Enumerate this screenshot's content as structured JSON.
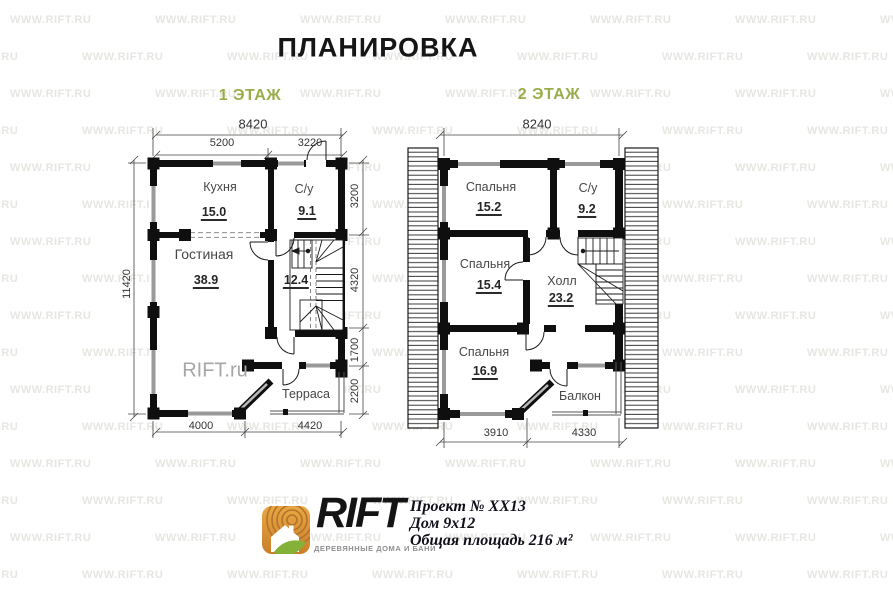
{
  "title": "ПЛАНИРОВКА",
  "watermark": {
    "text": "WWW.RIFT.RU"
  },
  "floor1": {
    "label": "1 ЭТАЖ",
    "plan_watermark": "RIFT.ru",
    "dims": {
      "top_total": "8420",
      "top_left": "5200",
      "top_right": "3220",
      "left_total": "11420",
      "right": [
        "3200",
        "4320",
        "1700",
        "2200"
      ],
      "bottom": [
        "4000",
        "4420"
      ]
    },
    "rooms": {
      "kitchen": {
        "name": "Кухня",
        "area": "15.0"
      },
      "wc": {
        "name": "С/у",
        "area": "9.1"
      },
      "living": {
        "name": "Гостиная",
        "area": "38.9"
      },
      "hall": {
        "area": "12.4"
      },
      "terrace": {
        "name": "Терраса"
      }
    }
  },
  "floor2": {
    "label": "2 ЭТАЖ",
    "dims": {
      "top_total": "8240",
      "bottom": [
        "3910",
        "4330"
      ]
    },
    "rooms": {
      "bedroom1": {
        "name": "Спальня",
        "area": "15.2"
      },
      "wc": {
        "name": "С/у",
        "area": "9.2"
      },
      "bedroom2": {
        "name": "Спальня",
        "area": "15.4"
      },
      "hall": {
        "name": "Холл",
        "area": "23.2"
      },
      "bedroom3": {
        "name": "Спальня",
        "area": "16.9"
      },
      "balcony": {
        "name": "Балкон"
      }
    }
  },
  "footer": {
    "brand": "RIFT",
    "tagline": "ДЕРЕВЯННЫЕ ДОМА И БАНИ",
    "project_no": "Проект № XX13",
    "house_size": "Дом 9х12",
    "total_area": "Общая площадь 216 м²"
  },
  "colors": {
    "accent_green": "#9aad4b",
    "wall_black": "#0f0f0f",
    "logo_orange": "#dd9434",
    "logo_leaf_green": "#84b238"
  }
}
